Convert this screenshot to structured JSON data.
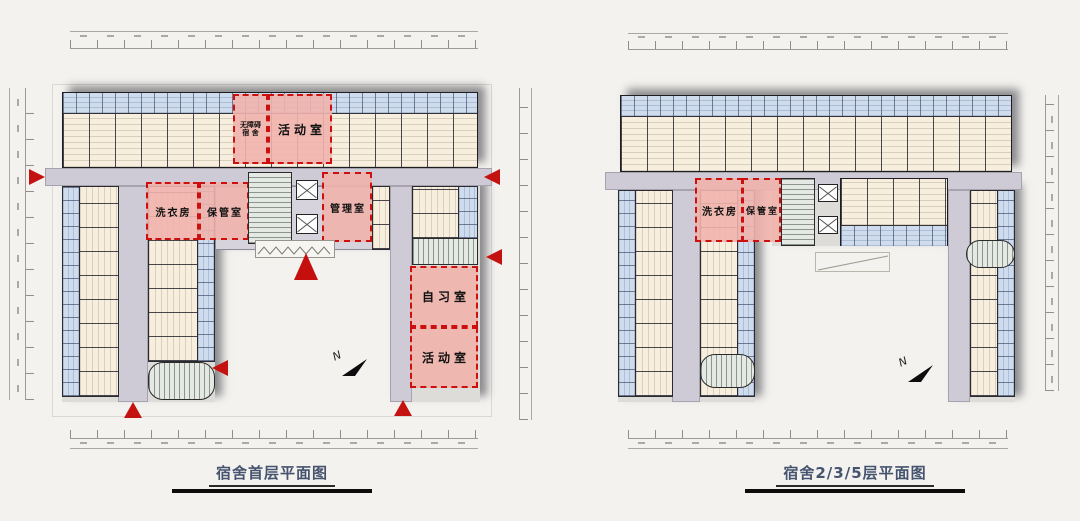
{
  "colors": {
    "room_fill": "#f7eedd",
    "bathroom_pod_fill": "#cfdcee",
    "corridor_fill": "#cecbd6",
    "highlight_fill": "#f0b2ac",
    "highlight_border": "#cc1010",
    "stair_fill": "#e4eae3",
    "entrance_arrow_red": "#c41210",
    "caption_text": "#46536e"
  },
  "plans": [
    {
      "caption": "宿舍首层平面图",
      "north_label": "N",
      "rooms": {
        "accessible_dorm_line1": "无障碍",
        "accessible_dorm_line2": "宿 舍",
        "activity_top": "活动室",
        "laundry": "洗衣房",
        "storage": "保管室",
        "management": "管理室",
        "study": "自习室",
        "activity_bottom": "活动室"
      }
    },
    {
      "caption": "宿舍2/3/5层平面图",
      "north_label": "N",
      "rooms": {
        "laundry": "洗衣房",
        "storage": "保管室"
      }
    }
  ]
}
